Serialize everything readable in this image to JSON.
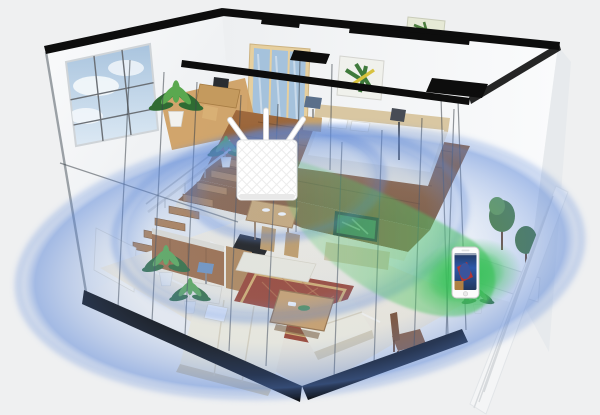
{
  "illustration": {
    "name": "wifi-router-beamforming-home-coverage",
    "house": {
      "floors": 2,
      "rooms": [
        "home-office",
        "bedroom",
        "stairs",
        "kitchen",
        "dining-area",
        "living-room",
        "patio"
      ]
    },
    "router": {
      "name": "wifi-router",
      "antenna_count": 3,
      "body_color_key": "router-white"
    },
    "target_device": {
      "name": "smartphone",
      "screen_content": "superhero-movie-still"
    },
    "coverage": {
      "blue_ring_count": 3,
      "beam": {
        "from": "wifi-router",
        "to": "smartphone",
        "color_key": "beam-green"
      }
    }
  },
  "colors": {
    "bg": "#eff0f1",
    "wall-white": "#fafbfc",
    "wall-shadow": "#e6e9ec",
    "beam-black": "#0d0d0d",
    "glass-line": "#3c434a",
    "sky": "#a9c4de",
    "cloud": "#f4f8fb",
    "wood-dark": "#7a4d28",
    "wood-mid": "#a06a3e",
    "wood-light": "#cfa064",
    "marble": "#eee6d4",
    "marble-light": "#f8f2e4",
    "sofa": "#f3eedd",
    "sofa-shadow": "#d8cdb2",
    "rug-red": "#9d4029",
    "rug-trim": "#d9ae66",
    "plant-dark": "#2f6b33",
    "plant-light": "#5aa84f",
    "wifi-rim": "#5d88d8",
    "wifi-fill": "#8fb0e6",
    "beam-green": "#4fc464",
    "glow-green": "#2fbf52",
    "router-white": "#ffffff",
    "router-line": "#e9e9e9",
    "phone-body": "#fcfcfc",
    "phone-frame": "#c9c9c9",
    "screen-navy": "#22375e",
    "screen-red": "#b23434",
    "screen-blue": "#2c58a9",
    "screen-amber": "#c98c3c",
    "door-blue": "#a5c2dc",
    "door-frame": "#e6cf9e",
    "tv-frame": "#22282d",
    "tv-screen": "#3c7a4e",
    "fence-white": "#f4f5f6"
  }
}
